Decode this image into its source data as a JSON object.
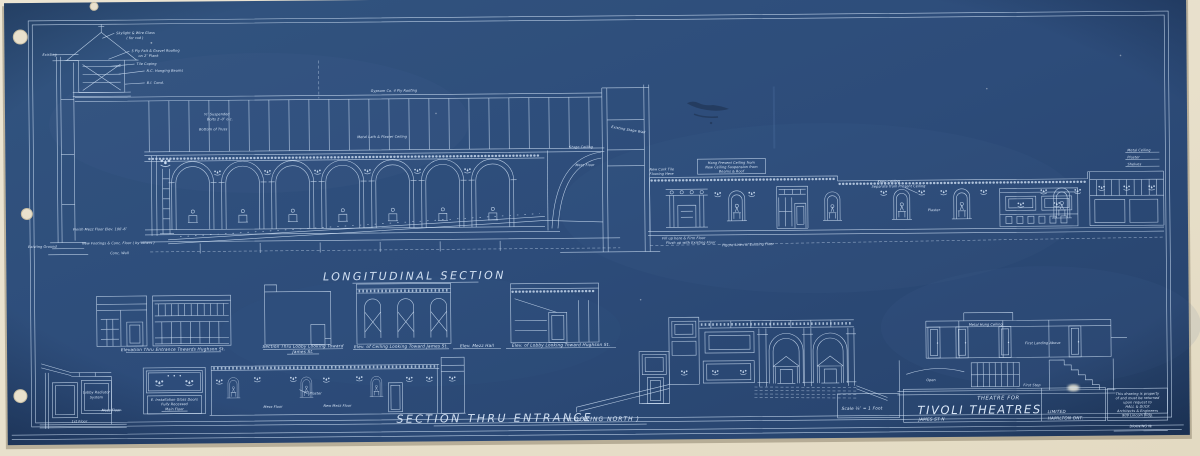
{
  "sheet": {
    "paper_color": "#e9e1cd",
    "blueprint_color": "#2e4e7d",
    "line_color": "#cfe0f4"
  },
  "headings": {
    "longitudinal_section": "LONGITUDINAL SECTION",
    "section_thru_entrance": "SECTION THRU ENTRANCE",
    "looking_north": "( LOOKING NORTH )"
  },
  "captions": {
    "elev_entrance_hughson": "Elevation Thru Entrance Towards Hughson St.",
    "section_lobby_james_1": "Section Thru Lobby Looking Toward",
    "section_lobby_james_2": "James St.",
    "elev_ceiling_james": "Elev. of Ceiling Looking Toward James St.",
    "elev_mezz_hall": "Elev. Mezz Hall",
    "elev_lobby_hughson": "Elev. of Lobby Looking Toward Hughson St."
  },
  "title_block": {
    "scale": "Scale ⅛″ = 1 Foot",
    "project": "THEATRE FOR",
    "client": "TIVOLI THEATRES",
    "company": "LIMITED",
    "city": "HAMILTON ONT.",
    "street": "JAMES ST N",
    "drawing_no_label": "DRAWING №",
    "stamp_line_1": "This drawing is property",
    "stamp_line_2": "of and must be returned",
    "stamp_line_3": "upon request to",
    "stamp_line_4": "HALL & DUCK",
    "stamp_line_5": "Architects & Engineers",
    "stamp_line_6": "909 Lincoln Bldg."
  },
  "annotations": {
    "skylight_1": "Skylight & Wire Glass",
    "skylight_2": "( for rod )",
    "roofing_1": "5 Ply Felt & Gravel Roofing",
    "roofing_2": "on 2″ Plank",
    "tile_coping": "Tile Coping",
    "hanging_beams": "R.C. Hanging Beams",
    "conduit": "B.I. Cond.",
    "existing": "Existing",
    "truss_1": "¾″ Suspended",
    "truss_2": "Bolts 2′-0″ o.c.",
    "truss_3": "Bottom of Truss",
    "metal_lath": "Metal Lath & Plaster Ceiling",
    "roof_spec": "Gypsum Co. 4 Ply Roofing",
    "mezz_elev": "Finish Mezz Floor Elev. 100′-6″",
    "existing_ground": "Existing Ground",
    "footings": "New Footings & Conc. Floor ( by others )",
    "conc_wall": "Conc. Wall",
    "stage_wall": "Existing Stage Wall",
    "stage_ceiling": "Stage Ceiling",
    "mezz_floor": "Mezz Floor",
    "cork_1": "New Cork Tile",
    "cork_2": "Flooring Here",
    "hang_note_1": "Hang Present Ceiling from",
    "hang_note_2": "New Ceiling Suspension from",
    "hang_note_3": "Beams & Roof",
    "keep_1": "Keep Ceiling",
    "keep_2": "Separate from Present Ceiling",
    "plaster": "Plaster",
    "figure_lines": "Figure Lines of Existing Floor",
    "fill_1": "Fill up here & Firm Floor",
    "fill_2": "Flush up with Existing Floor",
    "metal_ceiling": "Metal Ceiling",
    "shelves": "Shelves",
    "metal_hung_ceiling": "Metal Hung Ceiling",
    "open": "Open",
    "first_landing": "First Landing Above",
    "first_step": "First Step",
    "lobby_radiator_1": "Lobby Radiator",
    "lobby_radiator_2": "System",
    "first_floor": "1st Floor",
    "main_floor": "Main Floor",
    "install_1": "E. Installation Glass Doors",
    "install_2": "Fully Recessed",
    "new_mezz_floor": "New Mezz Floor"
  }
}
